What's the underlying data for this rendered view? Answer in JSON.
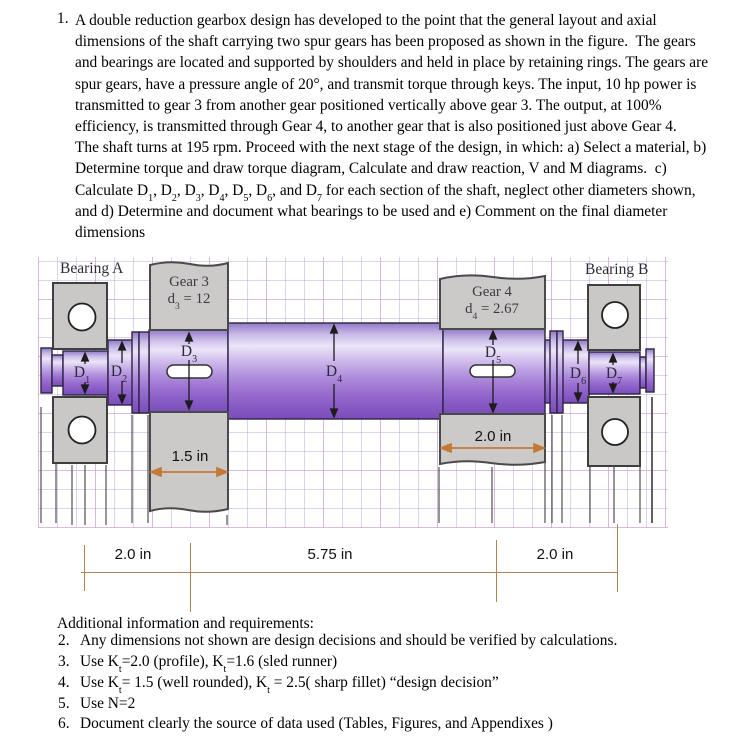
{
  "problem": {
    "number": "1.",
    "lines": [
      "A double reduction gearbox design has developed to the point that the general layout and axial",
      "dimensions of the shaft carrying two spur gears has been proposed as shown in the figure.  The gears",
      "and bearings are located and supported by shoulders and held in place by retaining rings. The gears are",
      "spur gears, have a pressure angle of 20°, and transmit torque through keys. The input, 10 hp power is",
      "transmitted to gear 3 from another gear positioned vertically above gear 3. The output, at 100%",
      "efficiency, is transmitted through Gear 4, to another gear that is also positioned just above Gear 4.",
      "The shaft turns at 195 rpm. Proceed with the next stage of the design, in which: a) Select a material, b)",
      "Determine torque and draw torque diagram, Calculate and draw reaction, V and M diagrams.  c)",
      "Calculate D{1}, D{2}, D{3}, D{4}, D{5}, D{6}, and D{7} for each section of the shaft, neglect other diameters shown,",
      "and d) Determine and document what bearings to be used and e) Comment on the final diameter",
      "dimensions"
    ]
  },
  "figure": {
    "bearing_a_label": "Bearing A",
    "bearing_b_label": "Bearing B",
    "gear3_name": "Gear 3",
    "gear3_spec": "d{3} = 12",
    "gear4_name": "Gear 4",
    "gear4_spec": "d{4} = 2.67",
    "d1": "D{1}",
    "d2": "D{2}",
    "d3": "D{3}",
    "d4": "D{4}",
    "d5": "D{5}",
    "d6": "D{6}",
    "d7": "D{7}",
    "gear3_hub_width": "1.5 in",
    "gear4_hub_width": "2.0 in",
    "colors": {
      "shaft_highlight": "#ebe5f8",
      "shaft_dark": "#7a4eba",
      "block_gray": "#cbcac8",
      "grid_purple": "#d9ccee",
      "grid_pink": "#f0d2e4",
      "dimension_brown": "#b5824f",
      "arrow_orange": "#c47a35"
    }
  },
  "dimension_chain": {
    "left": "2.0 in",
    "middle": "5.75 in",
    "right": "2.0 in"
  },
  "additional": {
    "heading": "Additional information and requirements:",
    "items": [
      {
        "number": "2.",
        "text": "Any dimensions not shown are design decisions and should be verified by calculations."
      },
      {
        "number": "3.",
        "text": "Use K{t}=2.0 (profile), K{t}=1.6 (sled runner)"
      },
      {
        "number": "4.",
        "text": "Use K{t}= 1.5 (well rounded), K{t} = 2.5( sharp fillet) “design decision”"
      },
      {
        "number": "5.",
        "text": "Use N=2"
      },
      {
        "number": "6.",
        "text": "Document clearly the source of data used (Tables, Figures, and Appendixes )"
      }
    ]
  }
}
